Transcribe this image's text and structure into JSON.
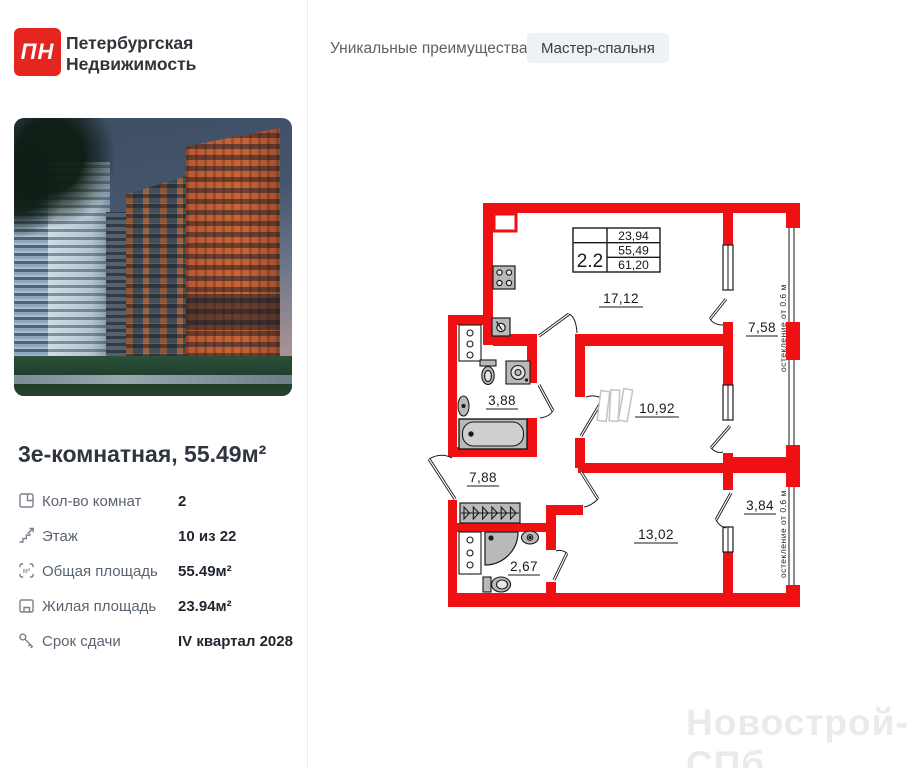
{
  "header": {
    "logo_text": "ПН",
    "brand_line1": "Петербургская",
    "brand_line2": "Недвижимость",
    "advantages_title": "Уникальные преимущества",
    "advantage_badge": "Мастер-спальня"
  },
  "listing": {
    "title": "3е-комнатная, 55.49м²",
    "specs": [
      {
        "icon": "rooms-icon",
        "label": "Кол-во комнат",
        "value": "2"
      },
      {
        "icon": "floor-icon",
        "label": "Этаж",
        "value": "10 из 22"
      },
      {
        "icon": "total-area-icon",
        "label": "Общая площадь",
        "value": "55.49м²"
      },
      {
        "icon": "living-area-icon",
        "label": "Жилая площадь",
        "value": "23.94м²"
      },
      {
        "icon": "key-icon",
        "label": "Срок сдачи",
        "value": "IV квартал 2028"
      }
    ]
  },
  "floor_plan": {
    "unit_type": "2.2",
    "areas_table": [
      "23,94",
      "55,49",
      "61,20"
    ],
    "room_areas": {
      "kitchen_living": "17,12",
      "balcony_top": "7,58",
      "bedroom_1": "10,92",
      "bathroom": "3,88",
      "hallway": "7,88",
      "bedroom_2": "13,02",
      "balcony_bottom": "3,84",
      "shower_room": "2,67"
    },
    "glazing_note": "остекление от 0.6 м"
  },
  "watermark": "Новострой-СПб",
  "colors": {
    "wall_red": "#ef1013",
    "logo_red": "#e52620",
    "badge_bg": "#eef1f5"
  }
}
